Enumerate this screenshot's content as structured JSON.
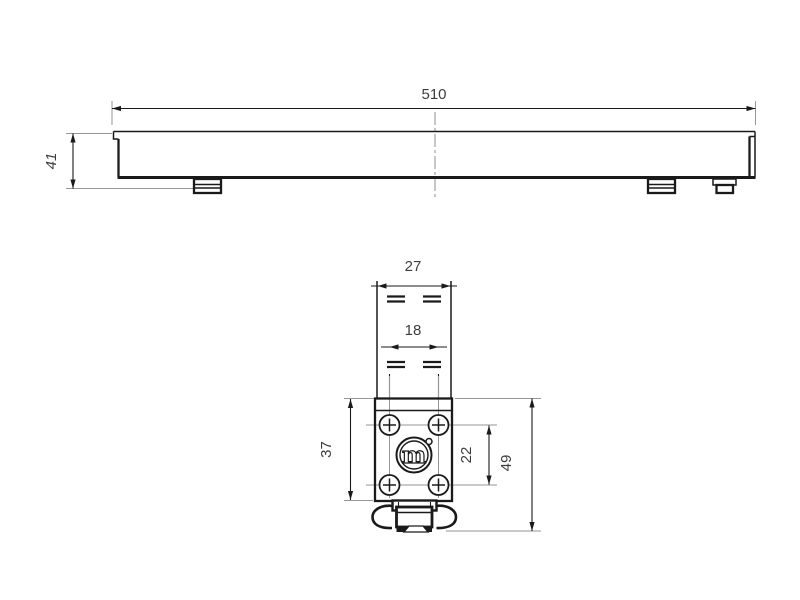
{
  "colors": {
    "background": "#ffffff",
    "line": "#1a1a1a",
    "dim_text": "#3d3d3d",
    "extension_line": "#969696"
  },
  "side_view": {
    "length": "510",
    "height": "41"
  },
  "bracket_view": {
    "rail_width": "27",
    "inner_width": "18",
    "plate_height": "37",
    "hole_spacing": "22",
    "total_height": "49",
    "logo_letter": "m"
  }
}
